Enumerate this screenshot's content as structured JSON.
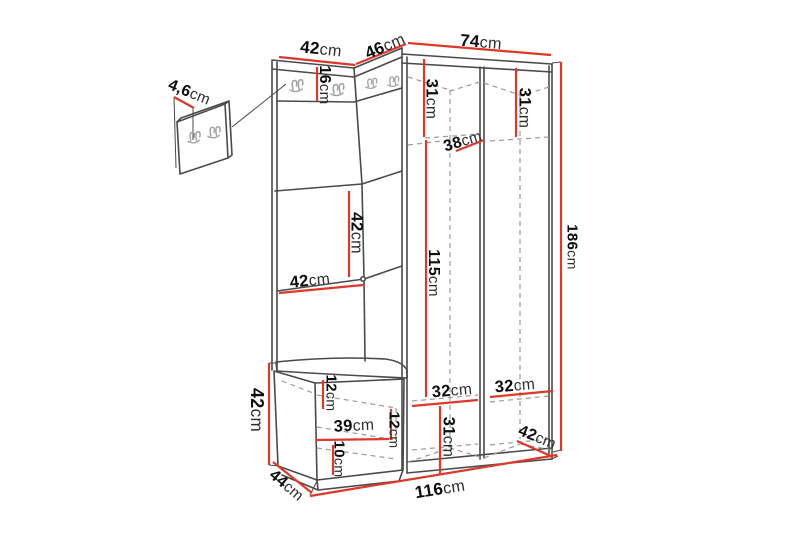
{
  "diagram": {
    "description": "Hallway furniture set dimension drawing (corner wardrobe with coat hooks, bench and wall hook panel)",
    "units": "cm"
  },
  "colors": {
    "background": "#ffffff",
    "dimension_line": "#dd382c",
    "outline": "#4a4a4a",
    "hidden_line": "#9a9a9a",
    "hook": "#a2a2a2",
    "label_number": "#0d0d0d",
    "label_unit": "#2e2e2e"
  },
  "dimensions": {
    "wall_panel_thickness": {
      "value": "4,6",
      "unit": "cm"
    },
    "left_section_width": {
      "value": "42",
      "unit": "cm"
    },
    "corner_section_width": {
      "value": "46",
      "unit": "cm"
    },
    "right_section_width": {
      "value": "74",
      "unit": "cm"
    },
    "hook_panel_height": {
      "value": "16",
      "unit": "cm"
    },
    "left_middle_compartment_height": {
      "value": "42",
      "unit": "cm"
    },
    "left_shelf_width": {
      "value": "42",
      "unit": "cm"
    },
    "right_left_top_compartment_height": {
      "value": "31",
      "unit": "cm"
    },
    "right_right_top_compartment_height": {
      "value": "31",
      "unit": "cm"
    },
    "top_shelf_depth": {
      "value": "38",
      "unit": "cm"
    },
    "hanging_space_height": {
      "value": "115",
      "unit": "cm"
    },
    "total_height": {
      "value": "186",
      "unit": "cm"
    },
    "bench_height": {
      "value": "42",
      "unit": "cm"
    },
    "bench_top_compartment_height": {
      "value": "12",
      "unit": "cm"
    },
    "bench_compartment_width": {
      "value": "39",
      "unit": "cm"
    },
    "bench_middle_compartment_height": {
      "value": "12",
      "unit": "cm"
    },
    "bench_bottom_compartment_height": {
      "value": "10",
      "unit": "cm"
    },
    "bench_depth": {
      "value": "44",
      "unit": "cm"
    },
    "total_width": {
      "value": "116",
      "unit": "cm"
    },
    "bottom_left_compartment_width": {
      "value": "32",
      "unit": "cm"
    },
    "bottom_right_compartment_width": {
      "value": "32",
      "unit": "cm"
    },
    "bottom_compartment_height": {
      "value": "31",
      "unit": "cm"
    },
    "wardrobe_depth": {
      "value": "42",
      "unit": "cm"
    }
  }
}
